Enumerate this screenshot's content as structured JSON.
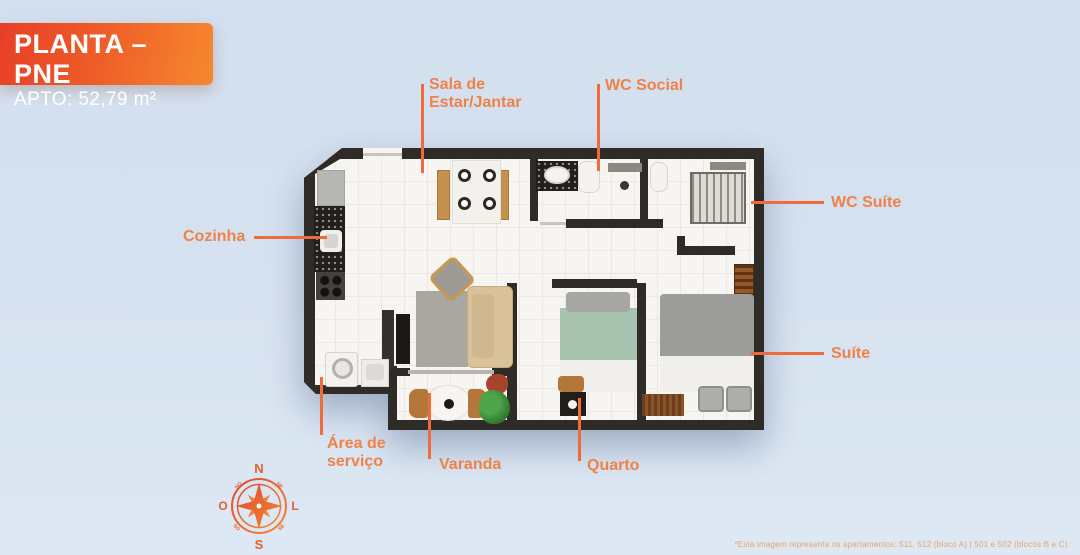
{
  "header": {
    "title": "PLANTA – PNE",
    "subtitle": "APTO: 52,79 m²"
  },
  "labels": {
    "sala": {
      "line1": "Sala de",
      "line2": "Estar/Jantar"
    },
    "wc_social": {
      "text": "WC Social"
    },
    "wc_suite": {
      "text": "WC Suíte"
    },
    "cozinha": {
      "text": "Cozinha"
    },
    "suite": {
      "text": "Suíte"
    },
    "area_servico": {
      "line1": "Área de",
      "line2": "serviço"
    },
    "varanda": {
      "text": "Varanda"
    },
    "quarto": {
      "text": "Quarto"
    }
  },
  "compass": {
    "north": "N",
    "south": "S",
    "east": "L",
    "west": "O",
    "northeast": "NE",
    "southeast": "SE",
    "southwest": "SO",
    "northwest": "NO"
  },
  "footnote": {
    "text": "*Esta imagem representa os apartamentos: 511, 512 (bloco A) | 501 e 502 (blocos B e C)."
  },
  "colors": {
    "background": "#d5e1ef",
    "title_gradient_start": "#e73f28",
    "title_gradient_end": "#f6872e",
    "accent_line": "#f06b3c",
    "label_text": "#ee8248",
    "wall": "#2f2c28",
    "floor": "#f7f5f1",
    "footnote_text": "#e9a463"
  }
}
